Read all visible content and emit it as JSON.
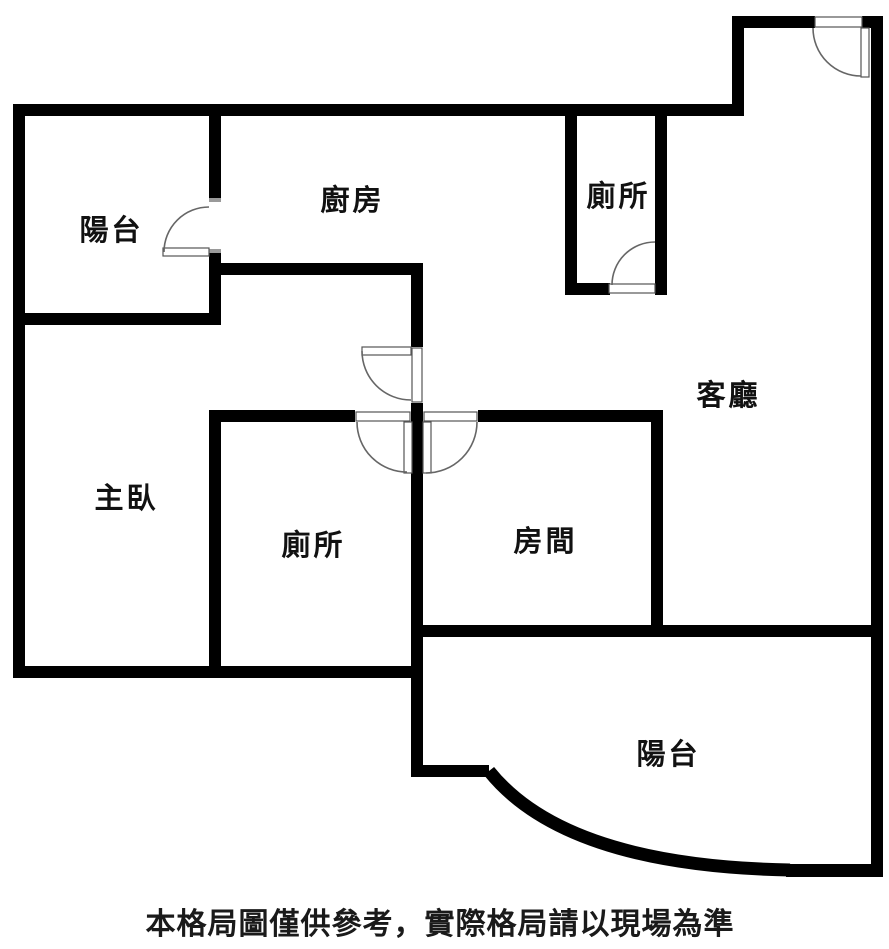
{
  "plan_title": "apartment-floor-plan",
  "colors": {
    "wall": "#000000",
    "background": "#ffffff",
    "label_text": "#111111",
    "door_line": "#666666"
  },
  "rooms": [
    {
      "id": "balcony-top",
      "label": "陽台"
    },
    {
      "id": "kitchen",
      "label": "廚房"
    },
    {
      "id": "toilet-top",
      "label": "廁所"
    },
    {
      "id": "living-room",
      "label": "客廳"
    },
    {
      "id": "master-bedroom",
      "label": "主臥"
    },
    {
      "id": "toilet-middle",
      "label": "廁所"
    },
    {
      "id": "bedroom",
      "label": "房間"
    },
    {
      "id": "balcony-bottom",
      "label": "陽台"
    }
  ],
  "disclaimer": "本格局圖僅供參考，實際格局請以現場為準"
}
